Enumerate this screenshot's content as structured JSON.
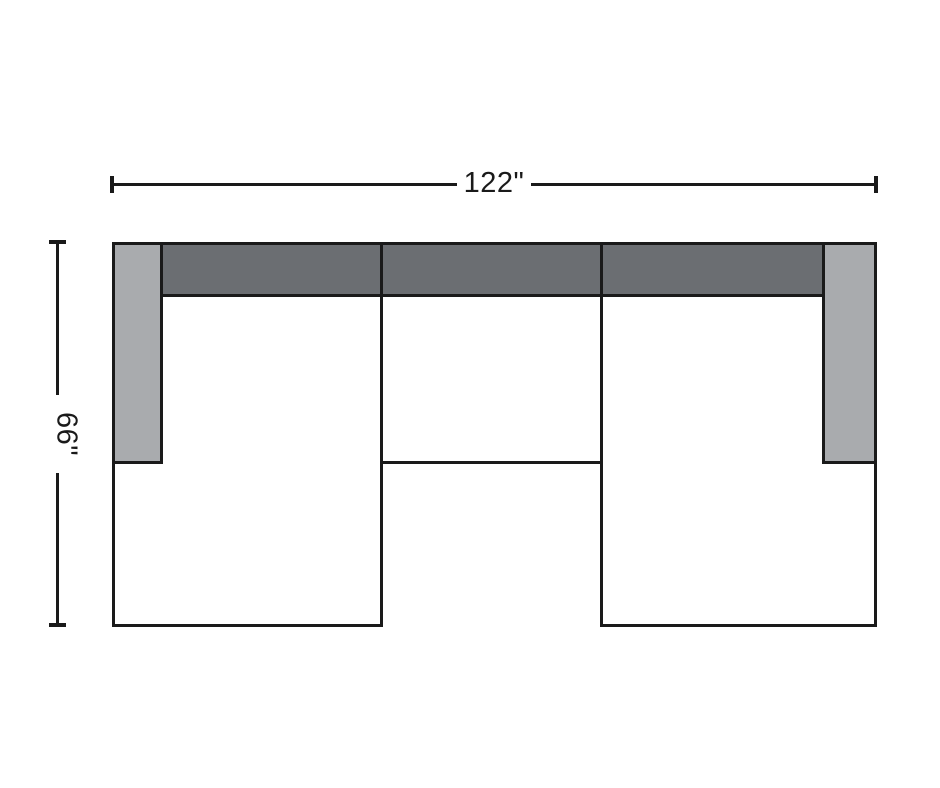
{
  "diagram": {
    "width_dimension": {
      "label": "122\""
    },
    "height_dimension": {
      "label": "66\""
    },
    "colors": {
      "background": "#ffffff",
      "line": "#1a1a1a",
      "back_cushion_fill": "#6b6e72",
      "armrest_fill": "#a9abae",
      "seat_fill": "#ffffff"
    }
  }
}
